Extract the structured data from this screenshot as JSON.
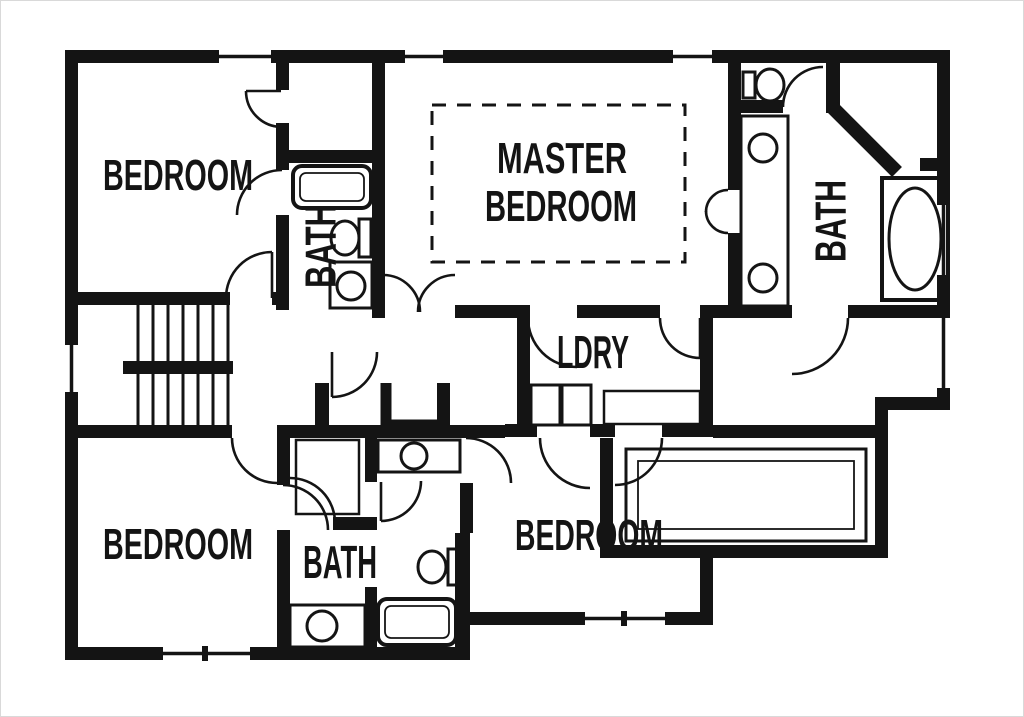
{
  "document": {
    "type": "floor-plan",
    "description": "Second-floor residential floor plan, black walls on white background"
  },
  "colors": {
    "wall": "#141414",
    "background": "#ffffff",
    "frame": "#d9d9d9",
    "text": "#141414"
  },
  "labels": {
    "bedroom_top_left": "BEDROOM",
    "bath_top_left": "BATH",
    "master_line1": "MASTER",
    "master_line2": "BEDROOM",
    "master_bath": "BATH",
    "laundry": "LDRY",
    "bedroom_bottom_left": "BEDROOM",
    "hall_bath": "BATH",
    "bedroom_bottom_right": "BEDROOM"
  },
  "rooms": [
    {
      "name": "bedroom-top-left",
      "label": "BEDROOM",
      "fixtures": [
        "closet",
        "door"
      ]
    },
    {
      "name": "bath-top-left",
      "label": "BATH",
      "orientation": "vertical",
      "fixtures": [
        "bathtub",
        "toilet",
        "sink-vanity"
      ]
    },
    {
      "name": "master-bedroom",
      "label": "MASTER BEDROOM",
      "note": "dashed ceiling/area outline",
      "fixtures": [
        "double-entry-doors"
      ]
    },
    {
      "name": "master-bath",
      "label": "BATH",
      "orientation": "vertical",
      "fixtures": [
        "water-closet-toilet",
        "double-sink-vanity",
        "corner-shower",
        "garden-tub"
      ]
    },
    {
      "name": "laundry",
      "label": "LDRY",
      "fixtures": [
        "washer",
        "dryer",
        "counter"
      ]
    },
    {
      "name": "bedroom-bottom-left",
      "label": "BEDROOM",
      "fixtures": [
        "door"
      ]
    },
    {
      "name": "hall-bath",
      "label": "BATH",
      "fixtures": [
        "sink-vanity",
        "toilet",
        "bathtub",
        "second-sink-vanity",
        "linen-closet"
      ]
    },
    {
      "name": "bedroom-bottom-right",
      "label": "BEDROOM",
      "fixtures": [
        "walk-in-closet"
      ]
    },
    {
      "name": "stairwell",
      "fixtures": [
        "double-run-stairs"
      ]
    }
  ],
  "window_count": 8,
  "door_count": 17
}
